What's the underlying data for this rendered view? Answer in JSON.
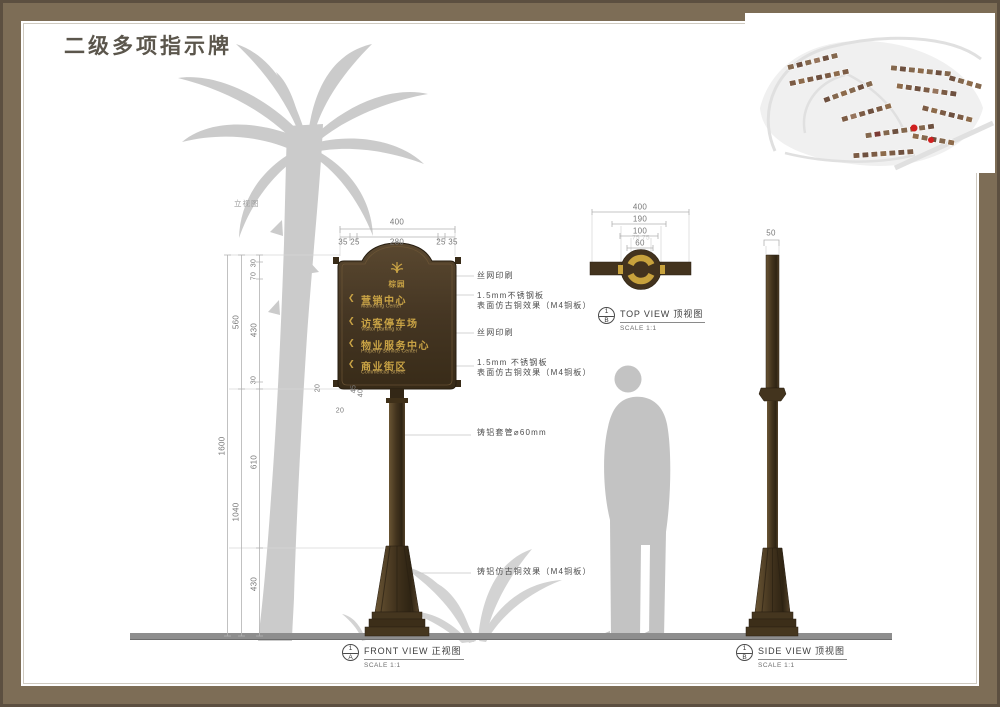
{
  "page": {
    "title": "二级多项指示牌"
  },
  "colors": {
    "frame": "#7d6d56",
    "panel": "#493a24",
    "gold": "#c9a345",
    "silhouette": "#c9c9c9",
    "red_dot": "#d01f1f"
  },
  "front_view": {
    "note": "立视图",
    "dim_top_total": "400",
    "dim_top_segments": [
      "35 25",
      "280",
      "25 35"
    ],
    "dims_left": {
      "total": "1600",
      "panel": "560",
      "pole": "1040",
      "arch_small": "30",
      "arch": "70",
      "body": "430",
      "bottom": "30",
      "pole_upper": "610",
      "base": "430"
    },
    "dims_joint": {
      "left": "20",
      "right_a": "45",
      "right_b": "40",
      "below": "20"
    },
    "sign": {
      "arrow": "❮",
      "logo": "棕园",
      "items": [
        {
          "cn": "营销中心",
          "en": "Marketing Center"
        },
        {
          "cn": "访客停车场",
          "en": "Visitor parking lot"
        },
        {
          "cn": "物业服务中心",
          "en": "Property Service Center"
        },
        {
          "cn": "商业街区",
          "en": "Commercial Street"
        }
      ]
    },
    "annotations": [
      {
        "l1": "丝网印刷",
        "l2": ""
      },
      {
        "l1": "1.5mm不锈钢板",
        "l2": "表面仿古铜效果（M4铜板）"
      },
      {
        "l1": "丝网印刷",
        "l2": ""
      },
      {
        "l1": "1.5mm 不锈钢板",
        "l2": "表面仿古铜效果（M4铜板）"
      },
      {
        "l1": "铸铝套管⌀60mm",
        "l2": ""
      },
      {
        "l1": "铸铝仿古铜效果（M4铜板）",
        "l2": ""
      }
    ],
    "label": {
      "num": "1",
      "letter": "A",
      "en": "FRONT VIEW",
      "cn": "正视图",
      "scale": "SCALE 1:1"
    }
  },
  "top_view": {
    "dims": [
      "400",
      "190",
      "100",
      "60"
    ],
    "faint": "75 75",
    "label": {
      "num": "1",
      "letter": "B",
      "en": "TOP VIEW",
      "cn": "顶视图",
      "scale": "SCALE 1:1"
    }
  },
  "side_view": {
    "dim_width": "50",
    "label": {
      "num": "1",
      "letter": "B",
      "en": "SIDE VIEW",
      "cn": "顶视图",
      "scale": "SCALE 1:1"
    }
  }
}
